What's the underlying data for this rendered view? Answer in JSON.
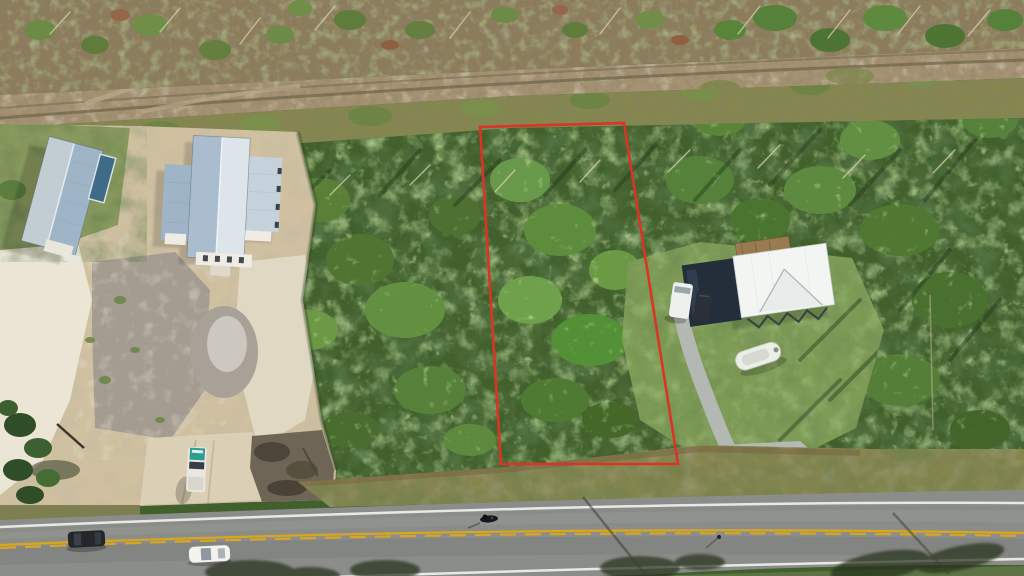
{
  "image": {
    "kind": "aerial-drone-photo",
    "subject": "Vacant wooded lot outlined in red along a two-lane highway, between two gray metal-roof buildings on a sandy cleared parcel (left) and a white-roof house with driveway, van and boat (right)"
  },
  "lot_outline": {
    "points": "480,127 624,123 678,464 501,464",
    "stroke": "#d93425",
    "stroke_width": "2.6"
  },
  "road": {
    "asphalt": "#8b8d8a",
    "edge_line": "#e8e9e6",
    "center_line": "#d9a61f",
    "center_line_style": "double-yellow, lower line dashed",
    "direction": "diagonal, lower-left to mid-right"
  },
  "palette": {
    "forest_base": "#41602c",
    "forest_light": "#6e9a42",
    "forest_dark": "#2a421e",
    "scrub_base": "#8d7c5a",
    "track_sand": "#a59272",
    "transition_scrub": "#85874f",
    "clearing_sand": "#cfc0a0",
    "white_sand": "#ebe5d5",
    "gray_dirt": "#a49b91",
    "lawn_left": "#8a9a5e",
    "lawn_right": "#7f9c57",
    "verge_grass": "#84854f",
    "roof_steel_light": "#dde4ea",
    "roof_steel_mid": "#a9bdcf",
    "roof_steel_dark": "#9fb4c6",
    "roof_white": "#f3f5f3",
    "dark_structure": "#232e3a",
    "driveway_concrete": "#b4b8b2",
    "bottom_grass": "#5e7243"
  },
  "vehicles": [
    {
      "name": "dark-suv-on-road",
      "color": "#23272b"
    },
    {
      "name": "white-car-on-road",
      "color": "#f2f2ee"
    },
    {
      "name": "white-pickup-on-sand-driveway",
      "color": "#e9e7df",
      "cargo_color": "#2f9e90"
    },
    {
      "name": "white-van-at-house",
      "color": "#eef0ee"
    },
    {
      "name": "boat-on-lawn",
      "color": "#eceee8"
    },
    {
      "name": "motorcycle-on-road",
      "color": "#16191c"
    }
  ],
  "buildings": [
    {
      "name": "left-gable-building",
      "roof": "gray-blue metal"
    },
    {
      "name": "center-cross-building",
      "roof": "gray-blue metal, cross plan"
    },
    {
      "name": "right-house",
      "roof": "white metal with gable"
    },
    {
      "name": "right-dark-structure",
      "roof": "dark navy"
    }
  ]
}
